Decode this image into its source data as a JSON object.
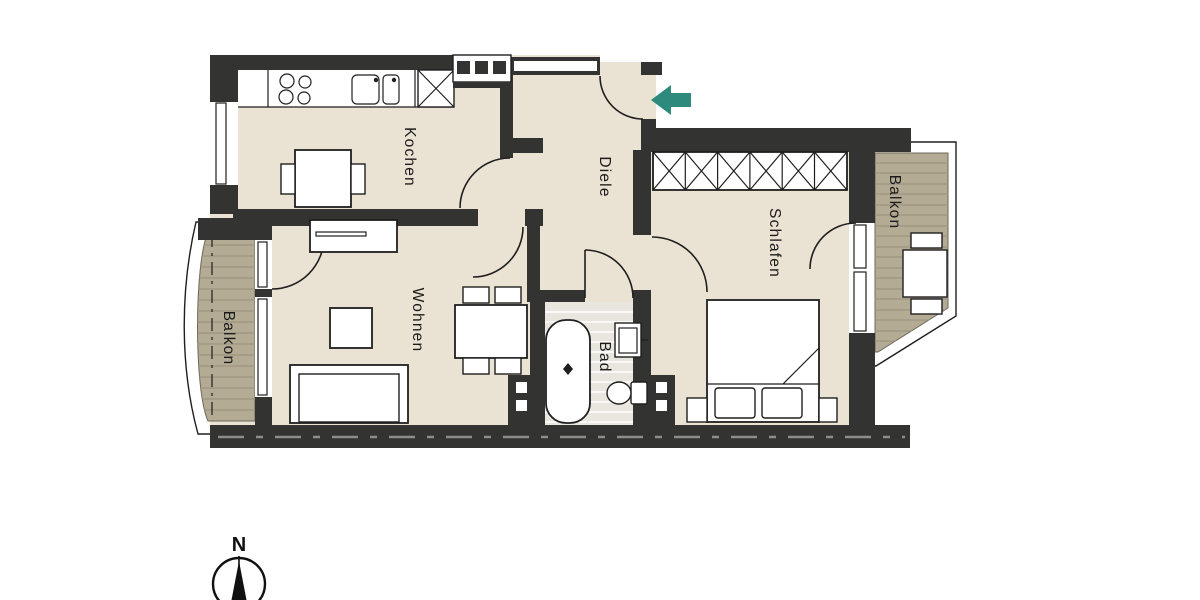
{
  "plan": {
    "type": "apartment-floor-plan",
    "rooms": [
      {
        "id": "kochen",
        "label": "Kochen"
      },
      {
        "id": "diele",
        "label": "Diele"
      },
      {
        "id": "schlafen",
        "label": "Schlafen"
      },
      {
        "id": "wohnen",
        "label": "Wohnen"
      },
      {
        "id": "bad",
        "label": "Bad"
      },
      {
        "id": "balkon-left",
        "label": "Balkon"
      },
      {
        "id": "balkon-right",
        "label": "Balkon"
      }
    ],
    "compass": {
      "north_label": "N"
    }
  },
  "colors": {
    "background": "#ffffff",
    "wall": "#333331",
    "floor": "#eae2d2",
    "bath_floor": "#e8e6df",
    "balcony": "#b4ab94",
    "balcony_stripe": "#9d9480",
    "balcony_edge": "#6b675c",
    "line": "#1f1f1f",
    "dash_line": "#8c8c8c",
    "entry_arrow": "#2e8a7c"
  }
}
